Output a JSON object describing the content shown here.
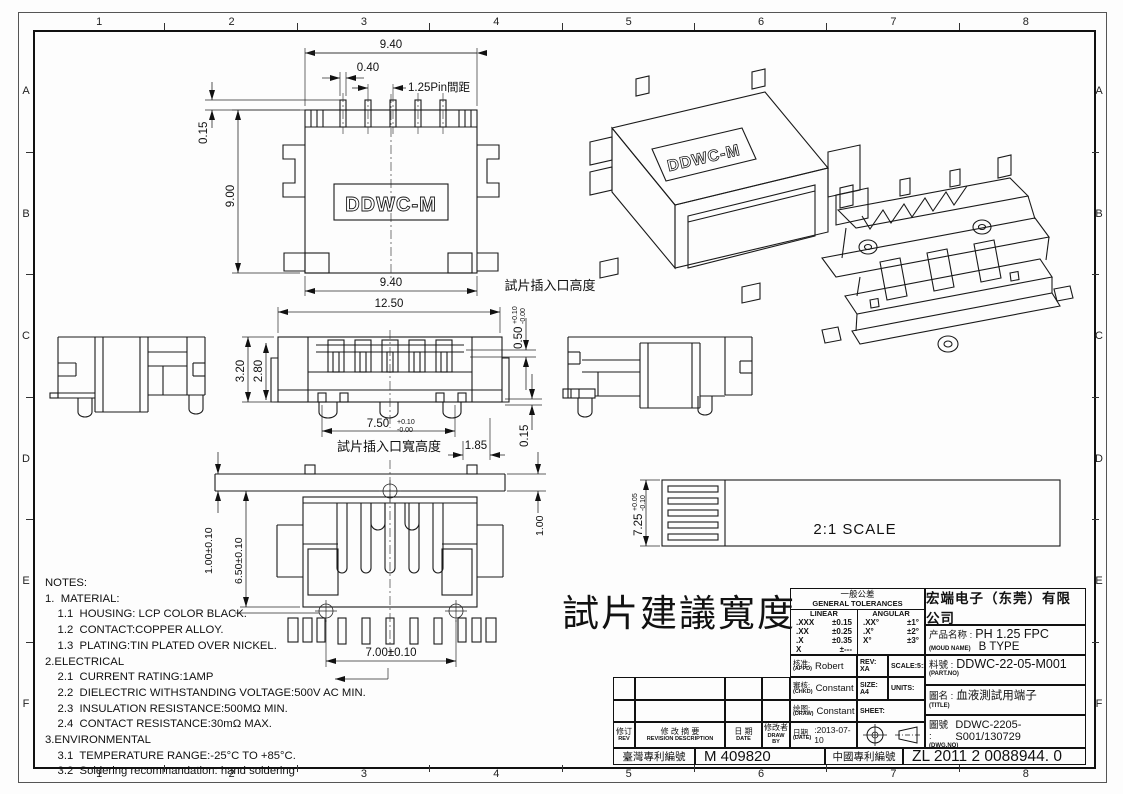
{
  "sheet": {
    "columns": [
      "1",
      "2",
      "3",
      "4",
      "5",
      "6",
      "7",
      "8"
    ],
    "rows": [
      "A",
      "B",
      "C",
      "D",
      "E",
      "F"
    ]
  },
  "drawing": {
    "logo": "DDWC-M",
    "big_label": "試片建議寬度",
    "dims": {
      "tv_w_top": "9.40",
      "tv_pin_w": "0.40",
      "tv_pitch": "1.25Pin間距",
      "tv_lead": "0.15",
      "tv_h": "9.00",
      "tv_w_bot": "9.40",
      "fv_w": "12.50",
      "fv_h": "3.20",
      "fv_h2": "2.80",
      "fv_slot": "7.50",
      "fv_slot_tp": "+0.10",
      "fv_slot_tm": "-0.00",
      "fv_slot_cap": "試片插入口寬高度",
      "fv_tab": "1.85",
      "fv_edge": "0.15",
      "fv_open": "0.50",
      "fv_open_tp": "+0.10",
      "fv_open_tm": "-0.00",
      "fv_open_cap": "試片插入口高度",
      "bv_pin": "1.00±0.10",
      "bv_body": "6.50±0.10",
      "bv_span": "7.00±0.10",
      "bv_right": "1.00",
      "sv_h": "7.25",
      "sv_tp": "+0.05",
      "sv_tm": "-0.10",
      "sv_scale": "2:1 SCALE"
    }
  },
  "notes": {
    "lines": [
      "NOTES:",
      "1.  MATERIAL:",
      "    1.1  HOUSING: LCP COLOR BLACK.",
      "    1.2  CONTACT:COPPER ALLOY.",
      "    1.3  PLATING:TIN PLATED OVER NICKEL.",
      "2.ELECTRICAL",
      "    2.1  CURRENT RATING:1AMP",
      "    2.2  DIELECTRIC WITHSTANDING VOLTAGE:500V AC MIN.",
      "    2.3  INSULATION RESISTANCE:500MΩ MIN.",
      "    2.4  CONTACT RESISTANCE:30mΩ MAX.",
      "3.ENVIRONMENTAL",
      "    3.1  TEMPERATURE RANGE:-25°C TO +85°C.",
      "    3.2  Soldering recommandation: hand soldering"
    ]
  },
  "tolerances": {
    "title_cn": "一般公差",
    "title_en": "GENERAL TOLERANCES",
    "linear_label": "LINEAR",
    "angular_label": "ANGULAR",
    "linear": [
      {
        "d": ".XXX",
        "t": "±0.15"
      },
      {
        "d": ".XX",
        "t": "±0.25"
      },
      {
        "d": ".X",
        "t": "±0.35"
      },
      {
        "d": "X",
        "t": "±---"
      }
    ],
    "angular": [
      {
        "d": ".XX°",
        "t": "±1°"
      },
      {
        "d": ".X°",
        "t": "±2°"
      },
      {
        "d": "X°",
        "t": "±3°"
      }
    ]
  },
  "title_block": {
    "company": "宏端电子（东莞）有限公司",
    "approvals": {
      "appd_cn": "核准:",
      "appd_en": "(APPD)",
      "appd": "Robert",
      "rev": "REV: XA",
      "scale": "SCALE:5:1",
      "chkd_cn": "審核:",
      "chkd_en": "(CHKD)",
      "chkd": "Constant",
      "size": "SIZE: A4",
      "units": "UNITS:",
      "draw_cn": "绘图:",
      "draw_en": "(DRAW)",
      "draw": "Constant",
      "sheet": "SHEET:",
      "date_cn": "日期",
      "date_en": "(DATE)",
      "date": ":2013-07-10"
    },
    "product": {
      "name_cn": "产品名称 :",
      "name_en": "(MOUD NAME)",
      "name": "PH 1.25 FPC",
      "type": "B TYPE",
      "part_cn": "料號 :",
      "part_en": "(PART.NO)",
      "part": "DDWC-22-05-M001",
      "title_cn": "圖名 :",
      "title_en": "(TITLE)",
      "title": "血液測試用端子",
      "dwg_cn": "圖號 :",
      "dwg_en": "(DWG.NO)",
      "dwg": "DDWC-2205-S001/130729"
    }
  },
  "revision_table": {
    "headers": [
      {
        "cn": "修订",
        "en": "REV"
      },
      {
        "cn": "修 改 摘 要",
        "en": "REVISION DESCRIPTION"
      },
      {
        "cn": "日 期",
        "en": "DATE"
      },
      {
        "cn": "修改者",
        "en": "DRAW BY"
      }
    ]
  },
  "patent": {
    "tw_label": "臺灣專利編號",
    "tw": "M 409820",
    "cn_label": "中國專利編號",
    "cn": "ZL 2011 2 0088944. 0"
  }
}
